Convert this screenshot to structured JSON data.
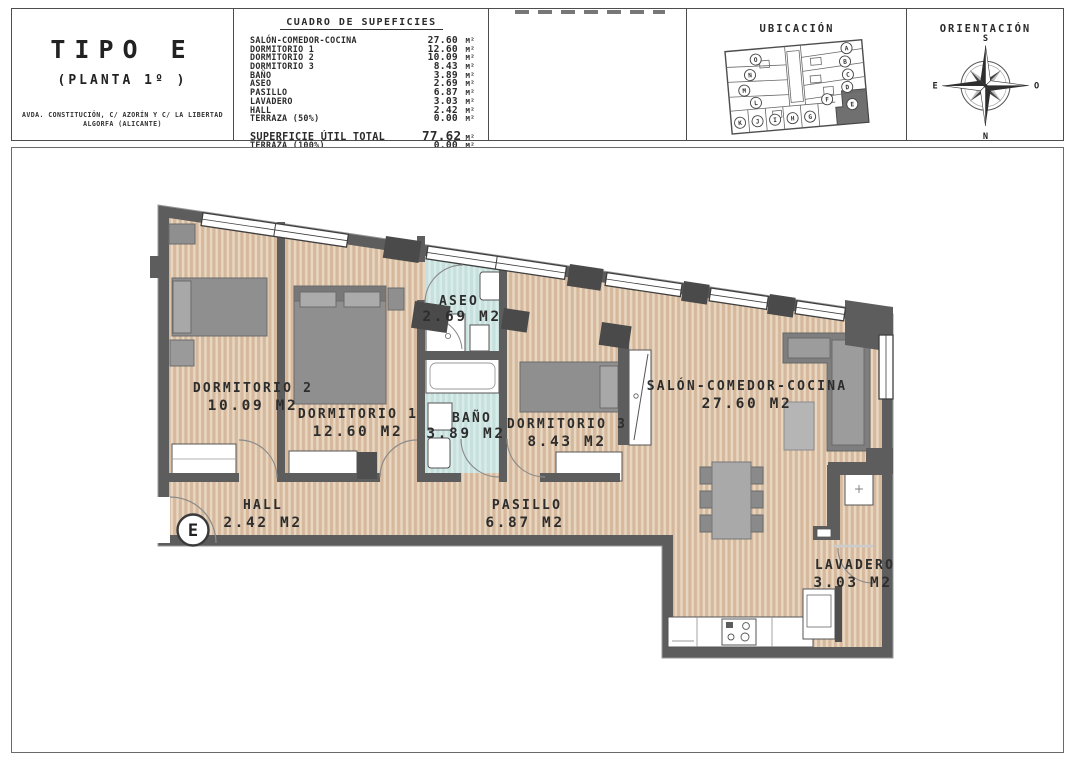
{
  "title_block": {
    "type_label": "TIPO E",
    "floor_label": "(PLANTA 1º )",
    "address_line1": "AVDA. CONSTITUCIÓN, C/ AZORÍN Y C/ LA LIBERTAD",
    "address_line2": "ALGORFA (ALICANTE)"
  },
  "surface_table": {
    "title": "CUADRO DE SUPEFICIES",
    "unit": "M²",
    "rows": [
      {
        "label": "SALÓN-COMEDOR-COCINA",
        "value": "27.60"
      },
      {
        "label": "DORMITORIO 1",
        "value": "12.60"
      },
      {
        "label": "DORMITORIO 2",
        "value": "10.09"
      },
      {
        "label": "DORMITORIO 3",
        "value": "8.43"
      },
      {
        "label": "BAÑO",
        "value": "3.89"
      },
      {
        "label": "ASEO",
        "value": "2.69"
      },
      {
        "label": "PASILLO",
        "value": "6.87"
      },
      {
        "label": "LAVADERO",
        "value": "3.03"
      },
      {
        "label": "HALL",
        "value": "2.42"
      },
      {
        "label": "TERRAZA (50%)",
        "value": "0.00"
      }
    ],
    "total_label": "SUPERFICIE ÚTIL TOTAL",
    "total_value": "77.62",
    "terraza100_label": "TERRAZA (100%)",
    "terraza100_value": "0.00"
  },
  "ubicacion": {
    "title": "UBICACIÓN",
    "letters": [
      "O",
      "N",
      "M",
      "L",
      "A",
      "B",
      "C",
      "D",
      "F",
      "E",
      "K",
      "J",
      "I",
      "H",
      "G"
    ],
    "highlighted_unit": "E"
  },
  "orientacion": {
    "title": "ORIENTACIÓN",
    "south": "S",
    "north": "N",
    "east": "E",
    "west": "O"
  },
  "plan": {
    "entrance_mark": "E",
    "rooms": [
      {
        "name": "DORMITORIO 2",
        "area": "10.09 M2"
      },
      {
        "name": "DORMITORIO 1",
        "area": "12.60 M2"
      },
      {
        "name": "ASEO",
        "area": "2.69 M2"
      },
      {
        "name": "BAÑO",
        "area": "3.89 M2"
      },
      {
        "name": "DORMITORIO 3",
        "area": "8.43 M2"
      },
      {
        "name": "SALÓN-COMEDOR-COCINA",
        "area": "27.60 M2"
      },
      {
        "name": "HALL",
        "area": "2.42 M2"
      },
      {
        "name": "PASILLO",
        "area": "6.87 M2"
      },
      {
        "name": "LAVADERO",
        "area": "3.03 M2"
      }
    ]
  },
  "colors": {
    "wall": "#5d5d5d",
    "floor_base": "#d6b99d",
    "floor_stripe": "#e8d7c1",
    "bath_floor": "#c6e0dd",
    "highlighted_unit_fill": "#707070"
  }
}
